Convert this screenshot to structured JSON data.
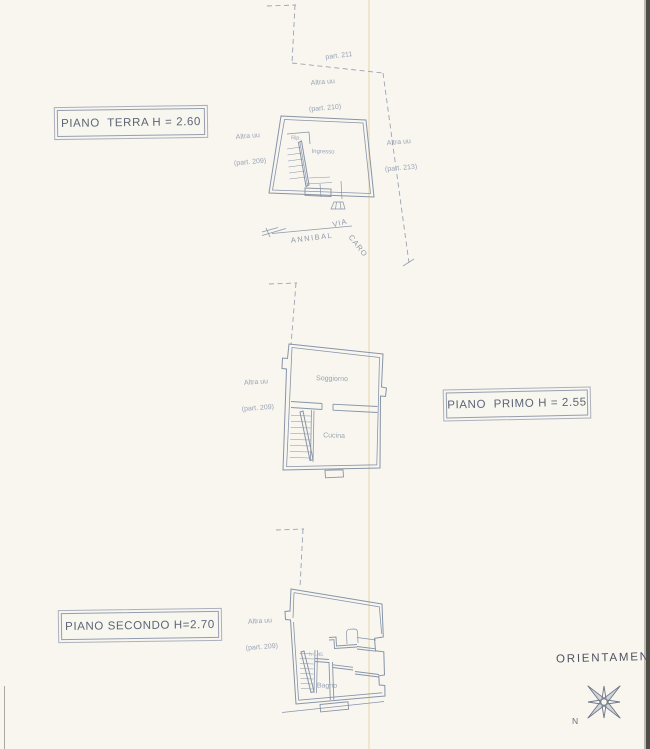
{
  "document": {
    "type": "scanned cadastral floor plan",
    "paper_color": "#f8f6ef",
    "ink_color": "#8b96a9",
    "title_text_color": "#5c6476",
    "faint_label_color": "#9aa3b6"
  },
  "titles": {
    "ground": "PIANO  TERRA H = 2.60",
    "first": "PIANO  PRIMO H = 2.55",
    "second": "PIANO SECONDO H=2.70"
  },
  "orientation": {
    "label": "ORIENTAMENTO",
    "north": "N"
  },
  "street": {
    "via": "VIA",
    "name1": "ANNIBAL",
    "name2": "CARO"
  },
  "parcels": {
    "top_boundary": "part. 211",
    "neighbor_above": {
      "line1": "Altra uu",
      "line2": "(part. 210)"
    },
    "neighbor_left_ground": {
      "line1": "Altra uu",
      "line2": "(part. 209)"
    },
    "neighbor_right_ground": {
      "line1": "Altra uu",
      "line2": "(part. 213)"
    },
    "neighbor_left_first": {
      "line1": "Altra uu",
      "line2": "(part. 209)"
    },
    "neighbor_left_second": {
      "line1": "Altra uu",
      "line2": "(part. 209)"
    }
  },
  "rooms": {
    "ground_storage": "Rip.",
    "ground_entrance": "Ingresso",
    "first_living": "Soggiorno",
    "first_kitchen": "Cucina",
    "second_bath": "Bagno",
    "second_height_note": "h 1.45"
  }
}
